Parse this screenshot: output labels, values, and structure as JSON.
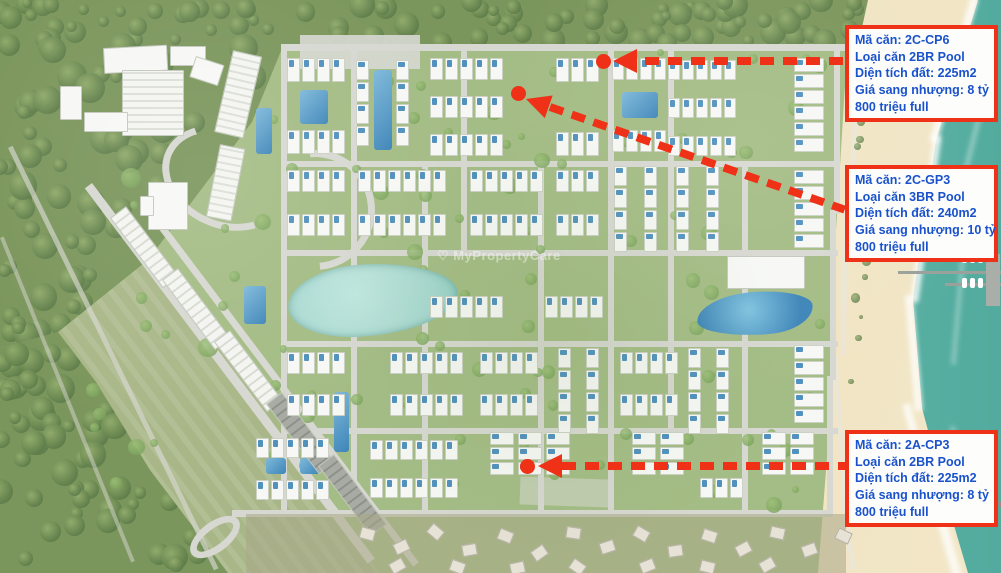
{
  "map_watermarks": {
    "center": "MyPropertyCare",
    "brand": "Batdongsan",
    "brand_suffix": ".com.vn"
  },
  "icons": {
    "heart": "♡",
    "house": "⌂"
  },
  "annotations": [
    {
      "unit_code": "2C-CP6",
      "lines": [
        "Mã căn: 2C-CP6",
        "Loại căn 2BR Pool",
        "Diện tích đất: 225m2",
        "Giá sang nhượng: 8 tỷ",
        "800 triệu full"
      ]
    },
    {
      "unit_code": "2C-GP3",
      "lines": [
        "Mã căn: 2C-GP3",
        "Loại căn 3BR Pool",
        "Diện tích đất: 240m2",
        "Giá sang nhượng: 10 tỷ",
        "800 triệu full"
      ]
    },
    {
      "unit_code": "2A-CP3",
      "lines": [
        "Mã căn: 2A-CP3",
        "Loại căn 2BR Pool",
        "Diện tích đất: 225m2",
        "Giá sang nhượng: 8 tỷ",
        "800 triệu full"
      ]
    }
  ],
  "colors": {
    "annotation_red": "#ee3117",
    "annotation_text_blue": "#1952cc",
    "card_bg": "#fdfdfb",
    "ocean_teal": "#63b9aa",
    "ocean_shallow": "#cfe9e0",
    "sand": "#eee0bd",
    "sand_dark": "#d6cfad",
    "grass": "#a4bc85",
    "field": "#a9b788",
    "forest": "#7b965c",
    "forest_tree_dark": "#5d7c49",
    "forest_tree_light": "#93ad6d",
    "site_tree": "#7aa35c",
    "pool_blue": "#3e85b8",
    "lagoon": "#a7d8d0",
    "road_gray": "#d7d8d1",
    "villa_white": "#f7f8f5",
    "village_house": "#e6e2d6",
    "village_ground": "#a8a887"
  }
}
